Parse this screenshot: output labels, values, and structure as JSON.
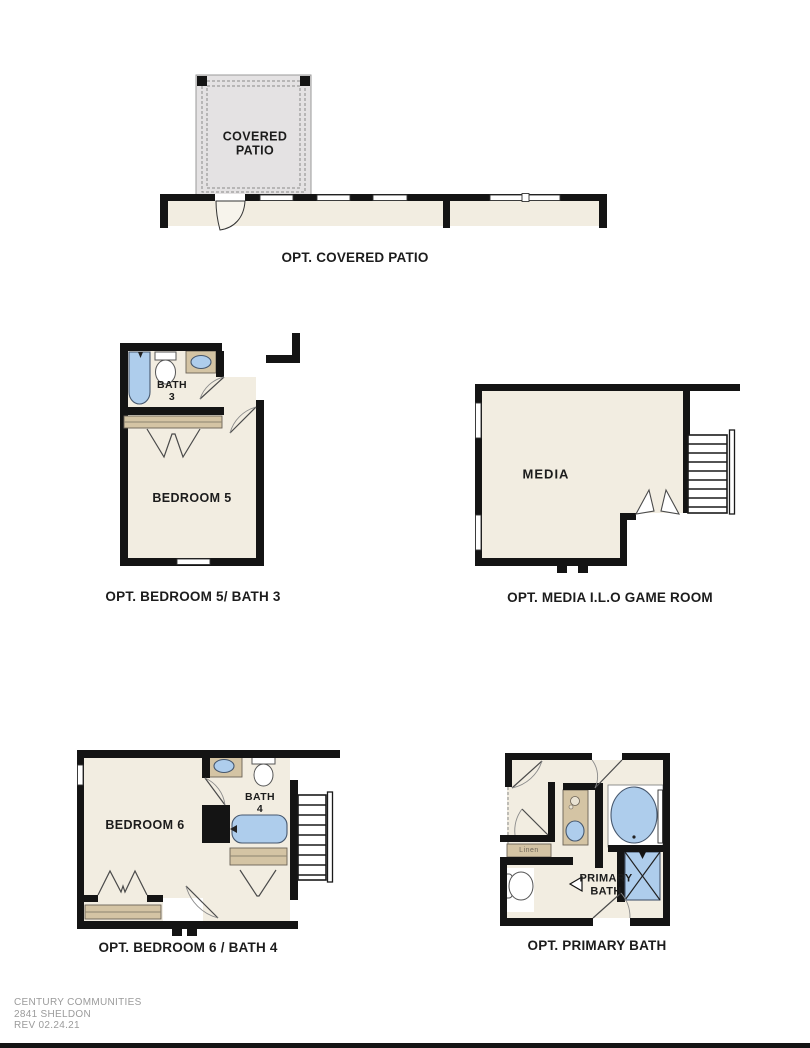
{
  "colors": {
    "wall": "#141414",
    "floor": "#f2ede1",
    "patio_fill": "#e4e2e3",
    "fixture_blue": "#aecdec",
    "cabinet_tan": "#d4c4a4",
    "text": "#1c1c1c",
    "footer_text": "#9b9b9b"
  },
  "plans": {
    "covered_patio": {
      "room_label": "COVERED\nPATIO",
      "caption": "OPT. COVERED PATIO"
    },
    "bedroom5_bath3": {
      "bath_label": "BATH\n3",
      "room_label": "BEDROOM 5",
      "caption": "OPT. BEDROOM 5/ BATH 3"
    },
    "media": {
      "room_label": "MEDIA",
      "caption": "OPT. MEDIA I.L.O GAME ROOM"
    },
    "bedroom6_bath4": {
      "room_label": "BEDROOM 6",
      "bath_label": "BATH\n4",
      "caption": "OPT. BEDROOM 6 / BATH 4"
    },
    "primary_bath": {
      "linen_label": "Linen",
      "room_label": "PRIMARY\nBATH",
      "caption": "OPT. PRIMARY BATH"
    }
  },
  "footer": {
    "company": "CENTURY COMMUNITIES",
    "plan_name": "2841 SHELDON",
    "revision": "REV 02.24.21"
  }
}
